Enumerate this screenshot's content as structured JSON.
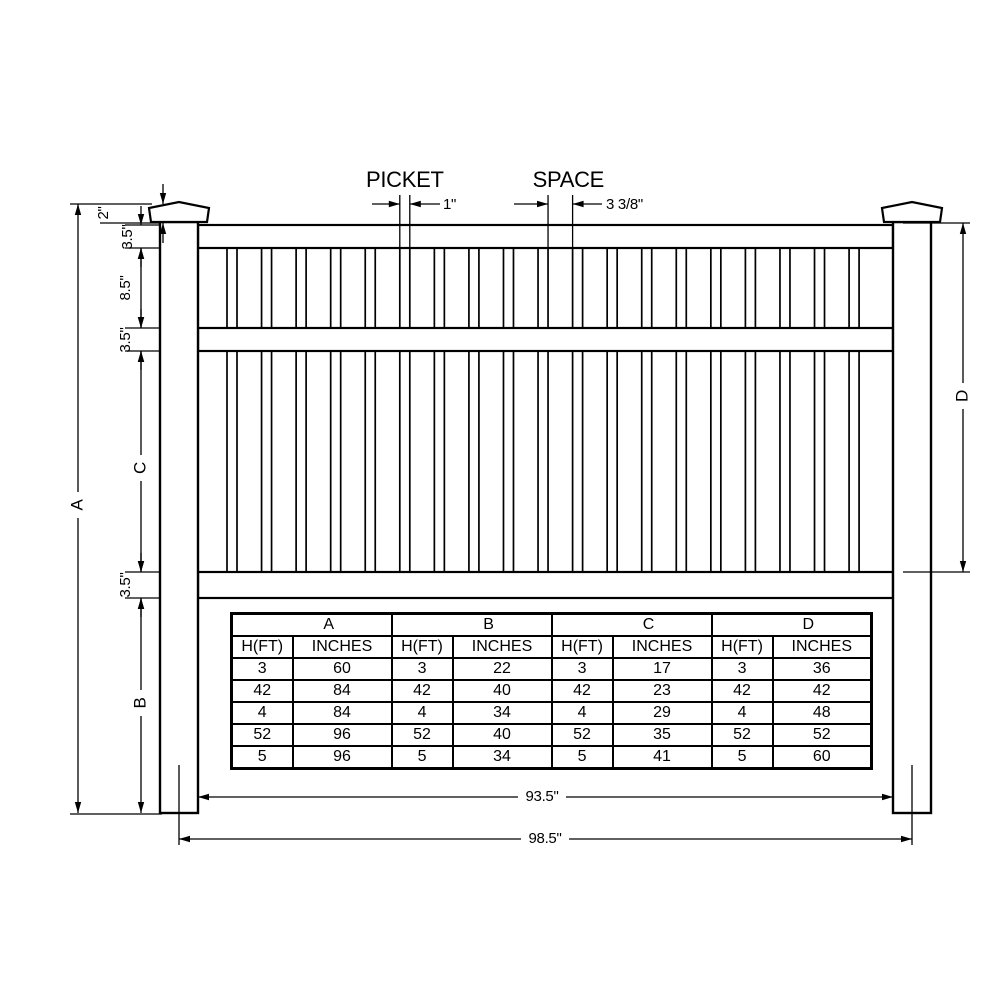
{
  "top_dimensions": {
    "picket_label": "PICKET",
    "picket_value": "1\"",
    "space_label": "SPACE",
    "space_value": "3 3/8\""
  },
  "left_dimensions": {
    "cap_height": "2\"",
    "top_rail_height": "3.5\"",
    "upper_picket_section": "8.5\"",
    "middle_rail_height": "3.5\"",
    "section_c": "C",
    "bottom_rail_height": "3.5\"",
    "section_b": "B",
    "overall_a": "A"
  },
  "right_dimensions": {
    "section_d": "D"
  },
  "bottom_dimensions": {
    "inner_width": "93.5\"",
    "outer_width": "98.5\""
  },
  "table": {
    "group_headers": [
      "A",
      "B",
      "C",
      "D"
    ],
    "sub_headers": [
      "H(FT)",
      "INCHES"
    ],
    "rows": [
      [
        "3",
        "60",
        "3",
        "22",
        "3",
        "17",
        "3",
        "36"
      ],
      [
        "42",
        "84",
        "42",
        "40",
        "42",
        "23",
        "42",
        "42"
      ],
      [
        "4",
        "84",
        "4",
        "34",
        "4",
        "29",
        "4",
        "48"
      ],
      [
        "52",
        "96",
        "52",
        "40",
        "52",
        "35",
        "52",
        "52"
      ],
      [
        "5",
        "96",
        "5",
        "34",
        "5",
        "41",
        "5",
        "60"
      ]
    ]
  },
  "colors": {
    "line": "#000000",
    "background": "#ffffff"
  }
}
